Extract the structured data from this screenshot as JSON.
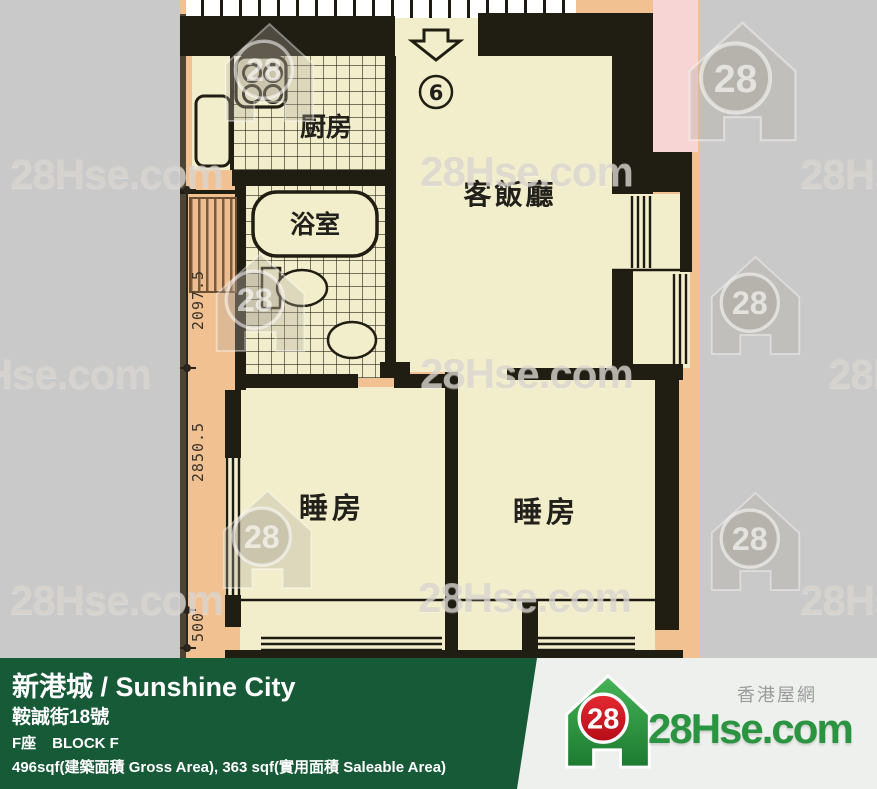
{
  "plan": {
    "unit_number": "6",
    "rooms": {
      "kitchen": "厨房",
      "bathroom": "浴室",
      "living_dining": "客飯廳",
      "bedroom1": "睡房",
      "bedroom2": "睡房"
    },
    "dimensions_mm": {
      "upper": "2097.5",
      "middle": "2850.5",
      "lower": "500"
    }
  },
  "watermark": {
    "text": "28Hse.com",
    "badge": "28"
  },
  "footer": {
    "title": "新港城 / Sunshine City",
    "address": "鞍誠街18號",
    "block_zh": "F座",
    "block_en": "BLOCK F",
    "area": "496sqf(建築面積 Gross Area), 363 sqf(實用面積 Saleable Area)"
  },
  "logo": {
    "badge": "28",
    "brand": "28Hse.com",
    "tagline": "香港屋網"
  },
  "colors": {
    "page_bg": "#c9c9c9",
    "footer_green": "#175a38",
    "logo_green": "#2b9441",
    "logo_red": "#cf1120",
    "plan_wall": "#201d13",
    "plan_room": "#f2eecb",
    "plan_surround": "#f2c191",
    "plan_pink": "#f7d5d5"
  }
}
